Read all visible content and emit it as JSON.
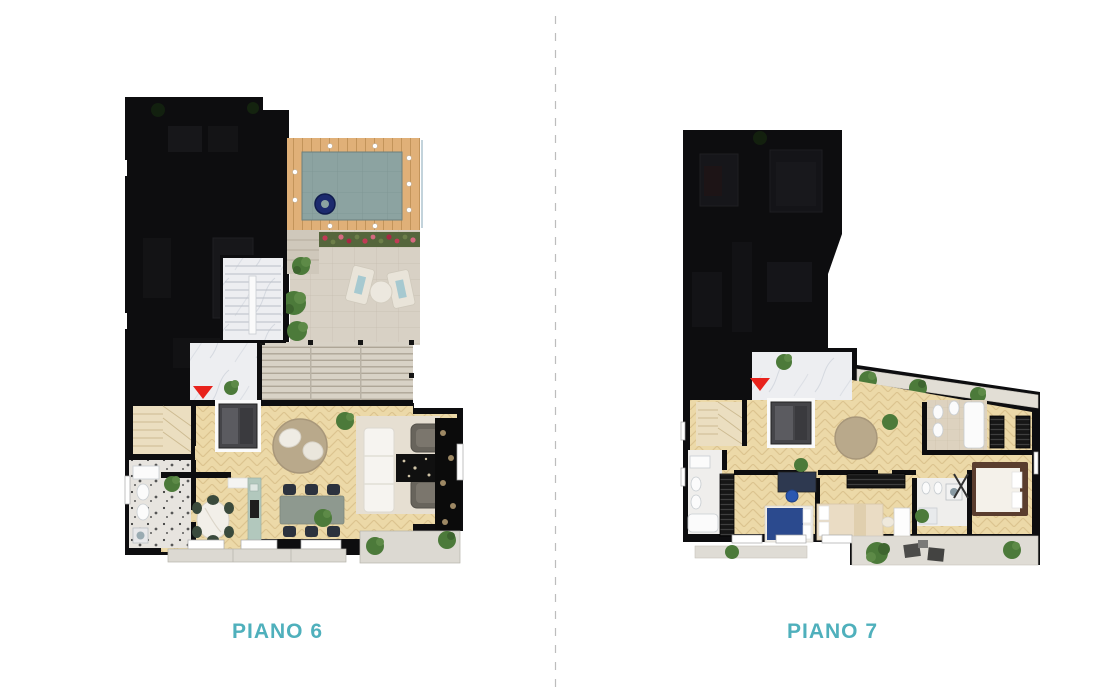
{
  "page": {
    "background": "#ffffff",
    "width": 1110,
    "height": 692
  },
  "divider": {
    "style": "dashed-vertical",
    "color": "#bdbdbd"
  },
  "plans": [
    {
      "id": "piano-6",
      "label": "PIANO 6",
      "features": [
        "darkened-adjacent-unit",
        "rooftop-pool",
        "pool-ring-float",
        "wood-pool-deck",
        "pool-lights",
        "flower-planter",
        "stone-terrace",
        "sun-loungers",
        "round-table",
        "pergola-louvered-roof",
        "marble-stairwell",
        "entrance-marker",
        "elevator",
        "internal-stairs",
        "bathroom",
        "kitchen-oval-table",
        "dining-table-six-chairs",
        "living-sofa",
        "armchairs",
        "round-rug",
        "plants",
        "balcony",
        "roof-terrace"
      ]
    },
    {
      "id": "piano-7",
      "label": "PIANO 7",
      "features": [
        "darkened-adjacent-unit",
        "marble-entry",
        "entrance-marker",
        "elevator",
        "internal-stairs",
        "bathroom-left",
        "bathroom-beige",
        "bathroom-middle",
        "bedroom-blue-bed",
        "bedroom-beige-bed",
        "master-bedroom",
        "wardrobes",
        "desk",
        "corridor-round-rug",
        "diagonal-balcony",
        "plants",
        "roof-terrace",
        "balcony"
      ]
    }
  ],
  "palette": {
    "page_bg": "#ffffff",
    "accent": "#4fb0bc",
    "wall": "#0d0d0f",
    "parquet": "#ecd9a8",
    "marble": "#edeef1",
    "deck_wood": "#e0b078",
    "pool_water": "#8ca3a1",
    "pool_float": "#1c2a6e",
    "stone_terrace": "#d8d1c5",
    "terrace_light": "#dfdcd5",
    "red_marker": "#e8221c",
    "plant_green": "#4c7a3a",
    "divider_gray": "#bdbdbd"
  }
}
